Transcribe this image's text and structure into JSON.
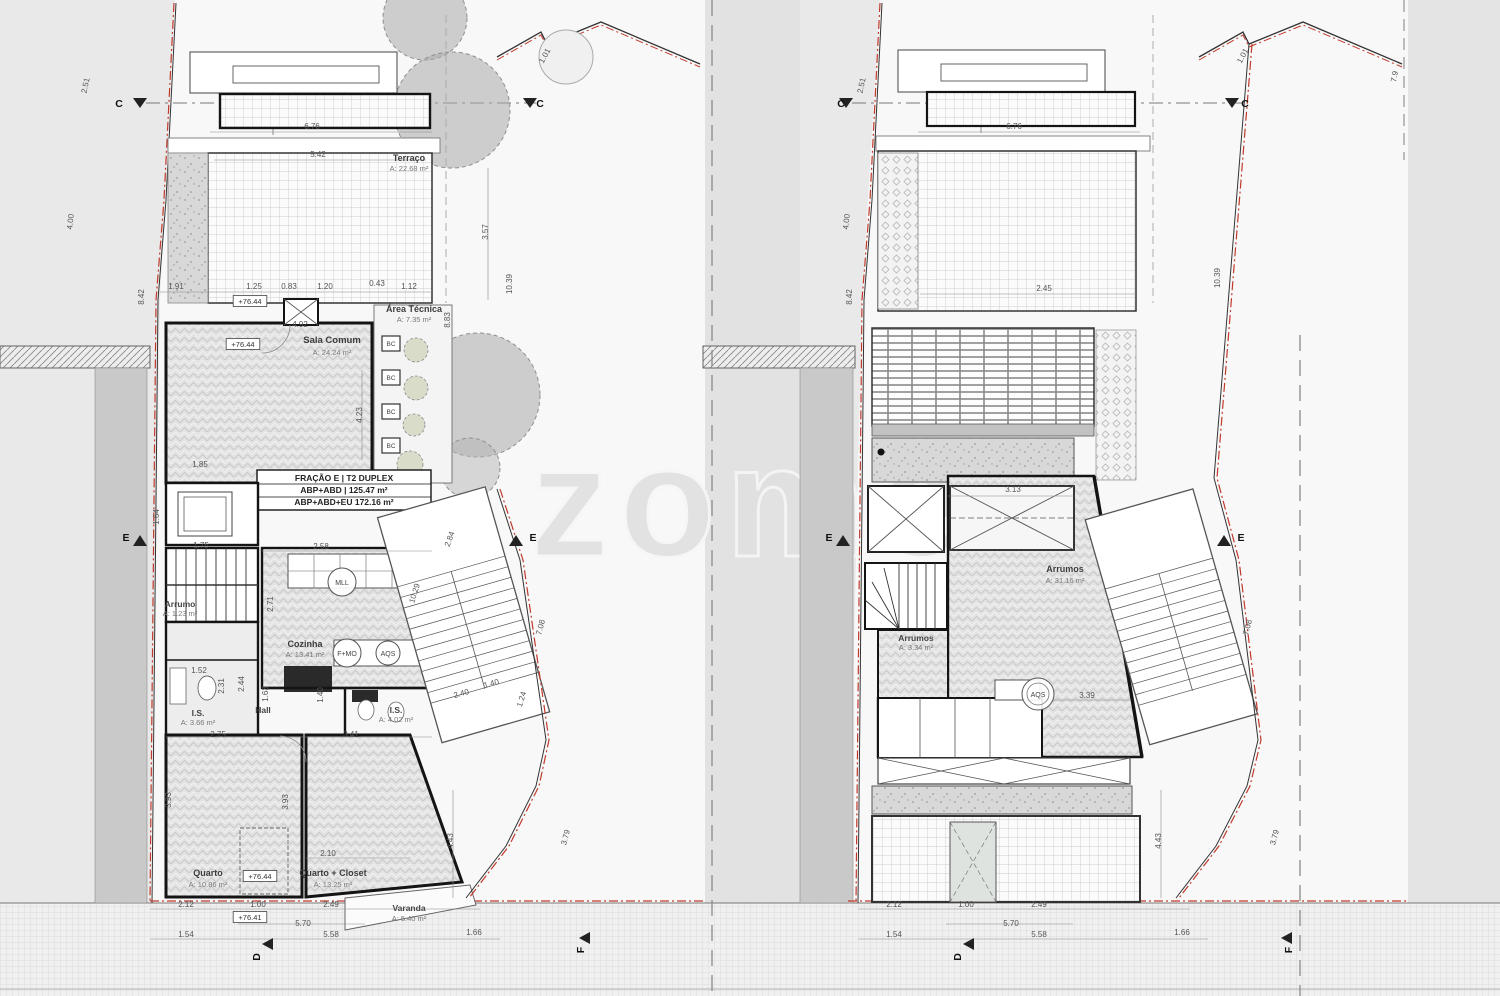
{
  "watermark": {
    "text": "zome"
  },
  "document": {
    "kind": "architectural floor plans, two levels side by side",
    "unit_info": [
      "FRAÇÃO E | T2 DUPLEX",
      "ABP+ABD | 125.47 m²",
      "ABP+ABD+EU 172.16 m²"
    ],
    "rooms_left_plan": [
      {
        "name": "Terraço",
        "area": "A: 22.68 m²"
      },
      {
        "name": "Área Técnica",
        "area": "A: 7.35 m²"
      },
      {
        "name": "Sala Comum",
        "area": "A: 24.24 m²"
      },
      {
        "name": "Cozinha",
        "area": "A: 13.41 m²"
      },
      {
        "name": "Arrumo",
        "area": "A: 1.23 m²"
      },
      {
        "name": "Hall",
        "area": ""
      },
      {
        "name": "I.S.",
        "area": "A: 3.66 m²"
      },
      {
        "name": "I.S.",
        "area": "A: 4.02 m²"
      },
      {
        "name": "Quarto",
        "area": "A: 10.86 m²"
      },
      {
        "name": "Quarto + Closet",
        "area": "A: 13.25 m²"
      },
      {
        "name": "Varanda",
        "area": "A: 5.40 m²"
      }
    ],
    "rooms_right_plan": [
      {
        "name": "Arrumos",
        "area": "A: 31.16 m²"
      },
      {
        "name": "Arrumos",
        "area": "A: 3.34 m²"
      }
    ],
    "equipment_symbols": [
      "MLL",
      "F+MO",
      "AQS",
      "BC"
    ],
    "section_markers": [
      "C",
      "E",
      "D",
      "F"
    ],
    "elevation_markers": [
      "+76.44",
      "+76.41"
    ]
  },
  "colors": {
    "background": "#e9e9e9",
    "paper": "#f8f8f8",
    "wall": "#141414",
    "boundary_red": "#c0392b",
    "neighbor_gray": "#c9c9c9",
    "watermark_gray": "#e0e0e0"
  },
  "labels": [
    {
      "t": "2.51",
      "x": 88,
      "y": 86,
      "r": -78
    },
    {
      "t": "4.00",
      "x": 73,
      "y": 222,
      "r": -84
    },
    {
      "t": "8.42",
      "x": 144,
      "y": 297,
      "r": -90
    },
    {
      "t": "1.01",
      "x": 547,
      "y": 57,
      "r": -62
    },
    {
      "t": "6.76",
      "x": 312,
      "y": 129
    },
    {
      "t": "5.42",
      "x": 318,
      "y": 157
    },
    {
      "t": "Terraço",
      "x": 409,
      "y": 161,
      "cls": "room2"
    },
    {
      "t": "A: 22.68 m²",
      "x": 409,
      "y": 171,
      "cls": "area"
    },
    {
      "t": "3.57",
      "x": 488,
      "y": 232,
      "r": -90
    },
    {
      "t": "10.39",
      "x": 512,
      "y": 284,
      "r": -90
    },
    {
      "t": "1.91",
      "x": 176,
      "y": 289
    },
    {
      "t": "1.25",
      "x": 254,
      "y": 289
    },
    {
      "t": "0.83",
      "x": 289,
      "y": 289
    },
    {
      "t": "1.20",
      "x": 325,
      "y": 289
    },
    {
      "t": "0.43",
      "x": 377,
      "y": 286
    },
    {
      "t": "1.12",
      "x": 409,
      "y": 289
    },
    {
      "t": "+76.44",
      "x": 250,
      "y": 304,
      "cls": "elev"
    },
    {
      "t": "4.92",
      "x": 300,
      "y": 327
    },
    {
      "t": "+76.44",
      "x": 243,
      "y": 347,
      "cls": "elev"
    },
    {
      "t": "Sala Comum",
      "x": 332,
      "y": 343,
      "cls": "room"
    },
    {
      "t": "A: 24.24 m²",
      "x": 332,
      "y": 355,
      "cls": "area"
    },
    {
      "t": "Área Técnica",
      "x": 414,
      "y": 312,
      "cls": "room2"
    },
    {
      "t": "A: 7.35 m²",
      "x": 414,
      "y": 322,
      "cls": "area"
    },
    {
      "t": "8.83",
      "x": 450,
      "y": 320,
      "r": -90
    },
    {
      "t": "4.23",
      "x": 362,
      "y": 415,
      "r": -90
    },
    {
      "t": "1.85",
      "x": 200,
      "y": 467
    },
    {
      "t": "FRAÇÃO E | T2 DUPLEX",
      "x": 344,
      "y": 481,
      "cls": "frak"
    },
    {
      "t": "ABP+ABD | 125.47 m²",
      "x": 344,
      "y": 493,
      "cls": "frak"
    },
    {
      "t": "ABP+ABD+EU 172.16 m²",
      "x": 344,
      "y": 505,
      "cls": "frak"
    },
    {
      "t": "1.64",
      "x": 159,
      "y": 517,
      "r": -90
    },
    {
      "t": "1.75",
      "x": 201,
      "y": 548
    },
    {
      "t": "2.58",
      "x": 321,
      "y": 549
    },
    {
      "t": "2.84",
      "x": 452,
      "y": 540,
      "r": -70
    },
    {
      "t": "10.29",
      "x": 417,
      "y": 594,
      "r": -73
    },
    {
      "t": "E",
      "x": 533,
      "y": 541,
      "cls": "marker"
    },
    {
      "t": "E",
      "x": 126,
      "y": 541,
      "cls": "marker"
    },
    {
      "t": "MLL",
      "x": 342,
      "y": 585,
      "c": 14,
      "cls": "circ"
    },
    {
      "t": "2.71",
      "x": 273,
      "y": 604,
      "r": -90
    },
    {
      "t": "Arrumo",
      "x": 180,
      "y": 607,
      "cls": "room3"
    },
    {
      "t": "A: 1.23 m²",
      "x": 180,
      "y": 616,
      "cls": "area"
    },
    {
      "t": "1.52",
      "x": 199,
      "y": 673
    },
    {
      "t": "Cozinha",
      "x": 305,
      "y": 647,
      "cls": "room2"
    },
    {
      "t": "A: 13.41 m²",
      "x": 305,
      "y": 657,
      "cls": "area"
    },
    {
      "t": "F+MO",
      "x": 347,
      "y": 656,
      "c": 14,
      "cls": "circ"
    },
    {
      "t": "AQS",
      "x": 388,
      "y": 656,
      "c": 12,
      "cls": "circ"
    },
    {
      "t": "2.31",
      "x": 224,
      "y": 686,
      "r": -90
    },
    {
      "t": "2.44",
      "x": 244,
      "y": 684,
      "r": -90
    },
    {
      "t": "1.63",
      "x": 268,
      "y": 694,
      "r": -90
    },
    {
      "t": "1.40",
      "x": 323,
      "y": 695,
      "r": -90
    },
    {
      "t": "I.S.",
      "x": 198,
      "y": 716,
      "cls": "room3"
    },
    {
      "t": "A: 3.66 m²",
      "x": 198,
      "y": 725,
      "cls": "area"
    },
    {
      "t": "Hall",
      "x": 263,
      "y": 713,
      "cls": "room3"
    },
    {
      "t": "I.S.",
      "x": 396,
      "y": 713,
      "cls": "room3"
    },
    {
      "t": "A: 4.02 m²",
      "x": 396,
      "y": 722,
      "cls": "area"
    },
    {
      "t": "2.75",
      "x": 218,
      "y": 737
    },
    {
      "t": "3.41",
      "x": 351,
      "y": 737
    },
    {
      "t": "2.40",
      "x": 462,
      "y": 696,
      "r": -16
    },
    {
      "t": "1.40",
      "x": 492,
      "y": 686,
      "r": -16
    },
    {
      "t": "1.24",
      "x": 524,
      "y": 700,
      "r": -73
    },
    {
      "t": "7.08",
      "x": 543,
      "y": 628,
      "r": -75
    },
    {
      "t": "3.93",
      "x": 171,
      "y": 800,
      "r": -90
    },
    {
      "t": "3.93",
      "x": 288,
      "y": 802,
      "r": -90
    },
    {
      "t": "2.10",
      "x": 328,
      "y": 856
    },
    {
      "t": "Quarto",
      "x": 208,
      "y": 876,
      "cls": "room2"
    },
    {
      "t": "A: 10.86 m²",
      "x": 208,
      "y": 887,
      "cls": "area"
    },
    {
      "t": "+76.44",
      "x": 260,
      "y": 879,
      "cls": "elev"
    },
    {
      "t": "Quarto + Closet",
      "x": 333,
      "y": 876,
      "cls": "room2"
    },
    {
      "t": "A: 13.25 m²",
      "x": 333,
      "y": 887,
      "cls": "area"
    },
    {
      "t": "4.43",
      "x": 453,
      "y": 841,
      "r": -90
    },
    {
      "t": "3.79",
      "x": 568,
      "y": 838,
      "r": -75
    },
    {
      "t": "Varanda",
      "x": 409,
      "y": 911,
      "cls": "room3"
    },
    {
      "t": "A: 5.40 m²",
      "x": 409,
      "y": 921,
      "cls": "area"
    },
    {
      "t": "2.12",
      "x": 186,
      "y": 907
    },
    {
      "t": "1.00",
      "x": 258,
      "y": 907
    },
    {
      "t": "2.49",
      "x": 331,
      "y": 907
    },
    {
      "t": "+76.41",
      "x": 250,
      "y": 920,
      "cls": "elev"
    },
    {
      "t": "5.70",
      "x": 303,
      "y": 926
    },
    {
      "t": "1.54",
      "x": 186,
      "y": 937
    },
    {
      "t": "5.58",
      "x": 331,
      "y": 937
    },
    {
      "t": "1.66",
      "x": 474,
      "y": 935
    },
    {
      "t": "C",
      "x": 119,
      "y": 107,
      "cls": "marker"
    },
    {
      "t": "C",
      "x": 540,
      "y": 107,
      "cls": "marker"
    },
    {
      "t": "D",
      "x": 260,
      "y": 957,
      "r": -90,
      "cls": "marker"
    },
    {
      "t": "F",
      "x": 584,
      "y": 950,
      "r": -90,
      "cls": "marker"
    },
    {
      "t": "BC",
      "x": 391,
      "y": 346,
      "cls": "bc"
    },
    {
      "t": "BC",
      "x": 391,
      "y": 380,
      "cls": "bc"
    },
    {
      "t": "BC",
      "x": 391,
      "y": 414,
      "cls": "bc"
    },
    {
      "t": "BC",
      "x": 391,
      "y": 448,
      "cls": "bc"
    },
    {
      "t": "2.51",
      "x": 864,
      "y": 86,
      "r": -78
    },
    {
      "t": "4.00",
      "x": 849,
      "y": 222,
      "r": -84
    },
    {
      "t": "8.42",
      "x": 852,
      "y": 297,
      "r": -90
    },
    {
      "t": "1.01",
      "x": 1245,
      "y": 57,
      "r": -62
    },
    {
      "t": "7.9",
      "x": 1397,
      "y": 77,
      "r": -80
    },
    {
      "t": "6.76",
      "x": 1014,
      "y": 129
    },
    {
      "t": "2.45",
      "x": 1044,
      "y": 291
    },
    {
      "t": "10.39",
      "x": 1220,
      "y": 278,
      "r": -90
    },
    {
      "t": "3.13",
      "x": 1013,
      "y": 492
    },
    {
      "t": "Arrumos",
      "x": 1065,
      "y": 572,
      "cls": "room2"
    },
    {
      "t": "A: 31.16 m²",
      "x": 1065,
      "y": 583,
      "cls": "area"
    },
    {
      "t": "Arrumos",
      "x": 916,
      "y": 641,
      "cls": "room3"
    },
    {
      "t": "A: 3.34 m²",
      "x": 916,
      "y": 650,
      "cls": "area"
    },
    {
      "t": "AQS",
      "x": 1038,
      "y": 697,
      "c": 16,
      "cls": "circ"
    },
    {
      "t": "3.39",
      "x": 1087,
      "y": 698
    },
    {
      "t": "E",
      "x": 829,
      "y": 541,
      "cls": "marker"
    },
    {
      "t": "E",
      "x": 1241,
      "y": 541,
      "cls": "marker"
    },
    {
      "t": "7.08",
      "x": 1250,
      "y": 628,
      "r": -75
    },
    {
      "t": "4.43",
      "x": 1161,
      "y": 841,
      "r": -90
    },
    {
      "t": "3.79",
      "x": 1277,
      "y": 838,
      "r": -75
    },
    {
      "t": "C",
      "x": 841,
      "y": 107,
      "cls": "marker"
    },
    {
      "t": "C",
      "x": 1245,
      "y": 107,
      "cls": "marker"
    },
    {
      "t": "2.12",
      "x": 894,
      "y": 907
    },
    {
      "t": "1.00",
      "x": 966,
      "y": 907
    },
    {
      "t": "2.49",
      "x": 1039,
      "y": 907
    },
    {
      "t": "5.70",
      "x": 1011,
      "y": 926
    },
    {
      "t": "1.54",
      "x": 894,
      "y": 937
    },
    {
      "t": "5.58",
      "x": 1039,
      "y": 937
    },
    {
      "t": "1.66",
      "x": 1182,
      "y": 935
    },
    {
      "t": "D",
      "x": 961,
      "y": 957,
      "r": -90,
      "cls": "marker"
    },
    {
      "t": "F",
      "x": 1292,
      "y": 950,
      "r": -90,
      "cls": "marker"
    }
  ]
}
